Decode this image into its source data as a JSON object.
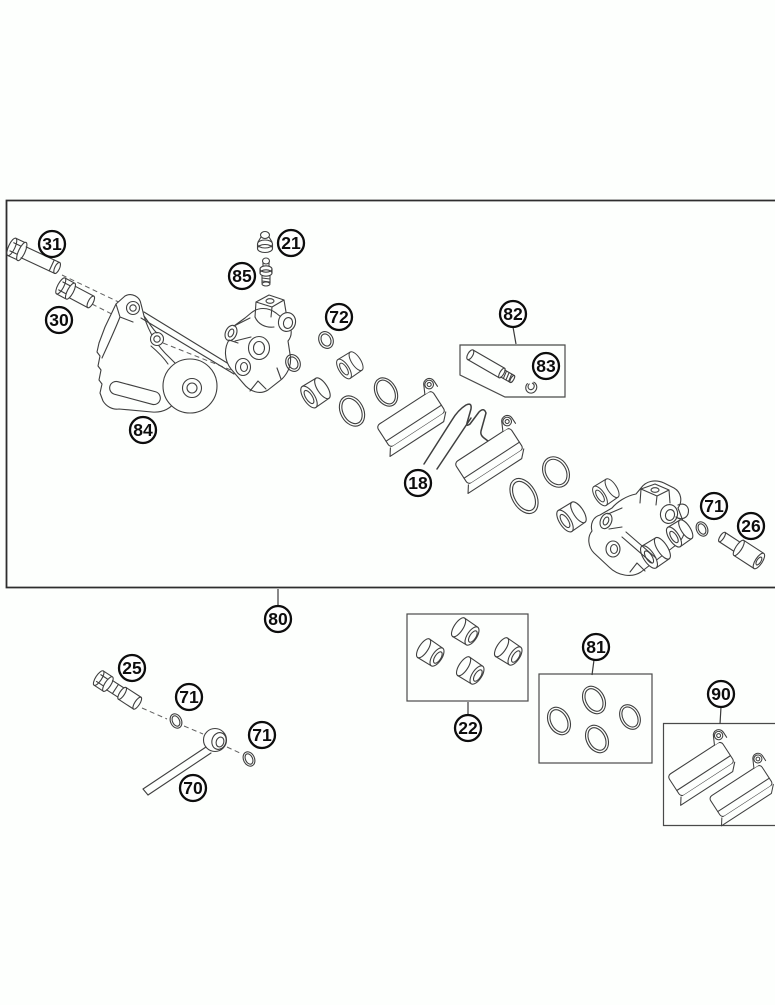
{
  "canvas": {
    "width": 775,
    "height": 1005,
    "background": "#fdfffd"
  },
  "styles": {
    "line_color": "#3f3f3f",
    "dash_color": "#5f5f5f",
    "frame_color": "#2e2e2e",
    "callout_stroke": "#0d0d0d",
    "callout_fill": "#fefefe",
    "callout_radius": 13,
    "callout_font_size": 17.5
  },
  "frame": {
    "path": "M775,200.5 L6.5,200.5 L6.5,587.5 L775,587.5"
  },
  "callouts": [
    {
      "label": "31",
      "x": 52,
      "y": 244
    },
    {
      "label": "30",
      "x": 59,
      "y": 320
    },
    {
      "label": "21",
      "x": 291,
      "y": 243
    },
    {
      "label": "85",
      "x": 242,
      "y": 276
    },
    {
      "label": "72",
      "x": 339,
      "y": 317
    },
    {
      "label": "82",
      "x": 513,
      "y": 314
    },
    {
      "label": "83",
      "x": 546,
      "y": 366
    },
    {
      "label": "84",
      "x": 143,
      "y": 430
    },
    {
      "label": "18",
      "x": 418,
      "y": 483
    },
    {
      "label": "71",
      "x": 714,
      "y": 506
    },
    {
      "label": "26",
      "x": 751,
      "y": 526
    },
    {
      "label": "80",
      "x": 278,
      "y": 619
    },
    {
      "label": "25",
      "x": 132,
      "y": 668
    },
    {
      "label": "71",
      "x": 189,
      "y": 697
    },
    {
      "label": "71",
      "x": 262,
      "y": 735
    },
    {
      "label": "70",
      "x": 193,
      "y": 788
    },
    {
      "label": "22",
      "x": 468,
      "y": 728
    },
    {
      "label": "81",
      "x": 596,
      "y": 647
    },
    {
      "label": "90",
      "x": 721,
      "y": 694
    }
  ],
  "leaders": [
    {
      "x1": 278,
      "y1": 606,
      "x2": 278,
      "y2": 589
    },
    {
      "x1": 513,
      "y1": 327,
      "x2": 516,
      "y2": 344
    },
    {
      "x1": 468,
      "y1": 715,
      "x2": 468,
      "y2": 702
    },
    {
      "x1": 594,
      "y1": 660,
      "x2": 592,
      "y2": 675
    },
    {
      "x1": 721,
      "y1": 707,
      "x2": 720,
      "y2": 724
    }
  ],
  "kit_boxes": [
    {
      "id": "kit-box-82",
      "shape": "polygon",
      "points": "460,345 565,345 565,397 505,397 460,375"
    },
    {
      "id": "kit-box-22",
      "shape": "rect",
      "x": 407,
      "y": 614,
      "w": 121,
      "h": 87
    },
    {
      "id": "kit-box-81",
      "shape": "rect",
      "x": 539,
      "y": 674,
      "w": 113,
      "h": 89
    },
    {
      "id": "kit-box-90",
      "shape": "path",
      "d": "M775,723.5 L663.5,723.5 L663.5,825.5 L775,825.5"
    }
  ],
  "parts": [
    {
      "callout": "31",
      "name": "flange-bolt"
    },
    {
      "callout": "30",
      "name": "collar-bushing"
    },
    {
      "callout": "84",
      "name": "caliper-support-bracket"
    },
    {
      "callout": "21",
      "name": "bleeder-cap"
    },
    {
      "callout": "85",
      "name": "bleeder-screw"
    },
    {
      "callout": "72",
      "name": "o-ring-small"
    },
    {
      "callout": "18",
      "name": "brake-pad-spring"
    },
    {
      "callout": "82",
      "name": "pad-pin-kit"
    },
    {
      "callout": "83",
      "name": "pin-clip"
    },
    {
      "callout": "80",
      "name": "brake-caliper-assembly"
    },
    {
      "callout": "71",
      "name": "sealing-ring"
    },
    {
      "callout": "26",
      "name": "banjo-bolt-socket"
    },
    {
      "callout": "25",
      "name": "hollow-screw"
    },
    {
      "callout": "70",
      "name": "brake-hose"
    },
    {
      "callout": "22",
      "name": "bushing-repair-kit"
    },
    {
      "callout": "81",
      "name": "o-ring-repair-kit"
    },
    {
      "callout": "90",
      "name": "brake-pads-kit"
    }
  ]
}
